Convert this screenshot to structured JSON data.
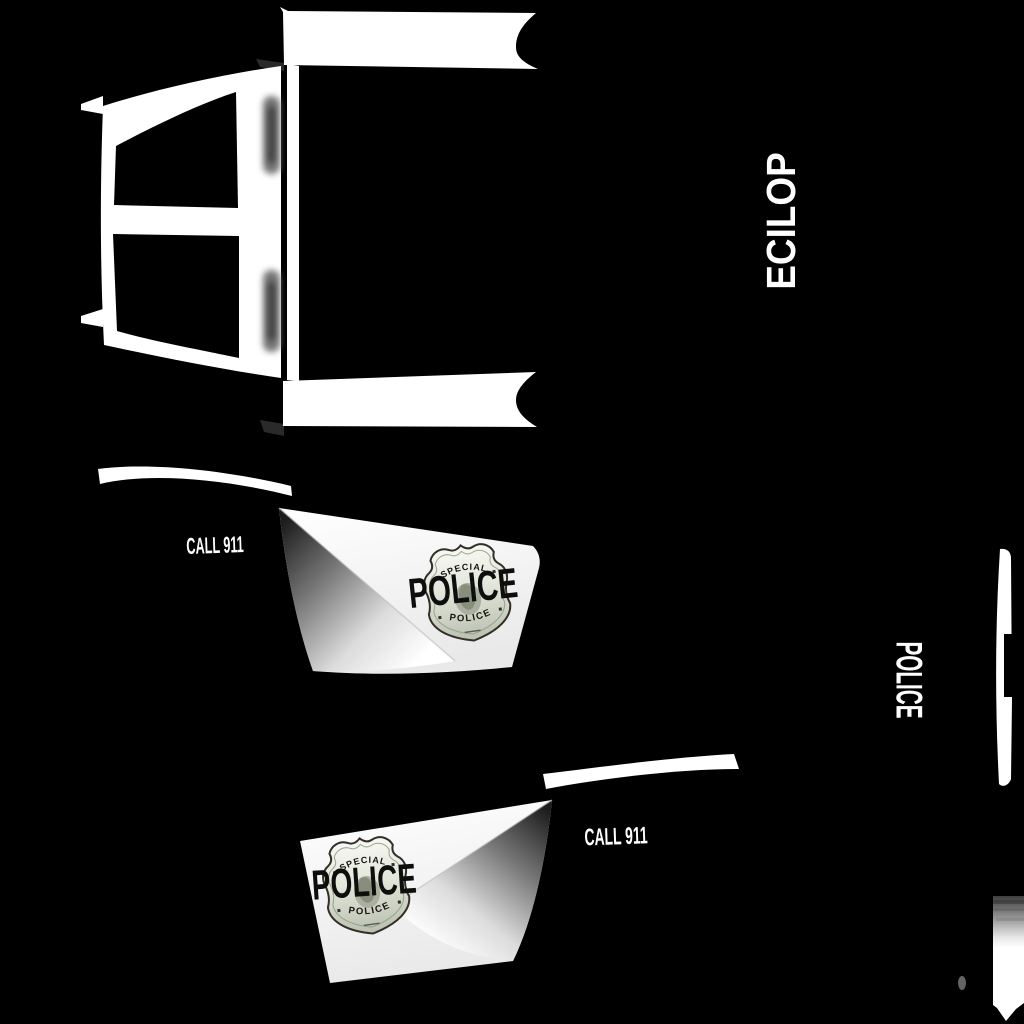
{
  "background_color": "#000000",
  "body_paint_color": "#ffffff",
  "side_text_top": {
    "label": "POLICE",
    "display_glyphs": "ECILOP",
    "color": "#ffffff"
  },
  "side_text_bottom": {
    "label": "POLICE",
    "color": "#ffffff"
  },
  "front_door": {
    "call_text": "CALL 911",
    "police_text": "POLICE",
    "call_text_color": "#ffffff",
    "police_text_color": "#0e0e0c"
  },
  "rear_door": {
    "call_text": "CALL 911",
    "police_text": "POLICE",
    "call_text_color": "#ffffff",
    "police_text_color": "#0e0e0c"
  },
  "badge": {
    "arc_top": "SPECIAL",
    "arc_bottom": "POLICE",
    "text_color": "#17140f",
    "metal_light": "#f8f9f4",
    "metal_dark": "#b9c0af"
  }
}
